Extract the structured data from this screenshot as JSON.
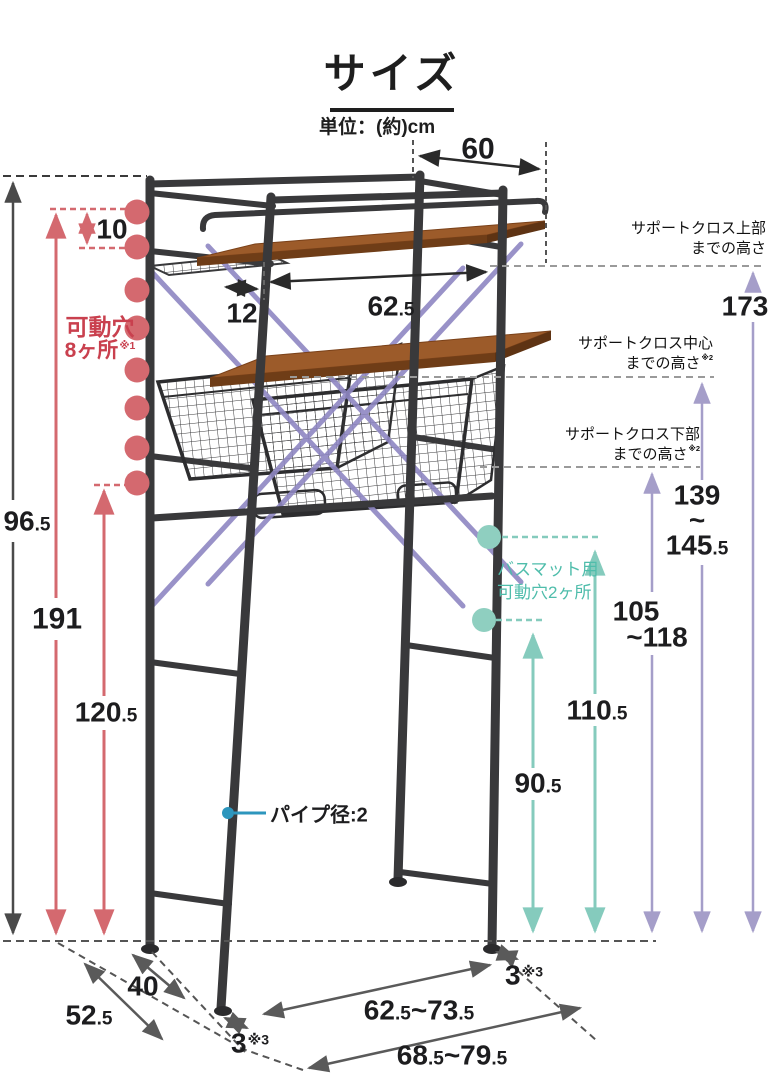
{
  "title": "サイズ",
  "unit": "単位：(約)cm",
  "dims": {
    "top_width": "60",
    "offset": "12",
    "shelf_width": "62.5",
    "gap": "10",
    "h_outer": "96.5",
    "h_total": "191",
    "h_lower": "120.5",
    "support_top": "173",
    "support_mid_a": "139",
    "support_mid_b": "~",
    "support_mid_c": "145.5",
    "support_low_a": "105",
    "support_low_b": "~118",
    "bath_upper": "110.5",
    "bath_lower": "90.5",
    "depth_inner": "40",
    "depth_outer": "52.5",
    "width_inner": "62.5~73.5",
    "width_outer": "68.5~79.5",
    "foot": "3",
    "foot_ref": "※3"
  },
  "labels": {
    "holes_a": "可動穴",
    "holes_b": "8ヶ所",
    "holes_ref": "※1",
    "support_top_a": "サポートクロス上部",
    "support_top_b": "までの高さ",
    "support_mid_a": "サポートクロス中心",
    "support_mid_b": "までの高さ",
    "support_mid_ref": "※2",
    "support_low_a": "サポートクロス下部",
    "support_low_b": "までの高さ",
    "support_low_ref": "※2",
    "bath_a": "バスマット用",
    "bath_b": "可動穴2ヶ所",
    "pipe": "パイプ径:2"
  },
  "colors": {
    "frame": "#39393b",
    "wood": "#9c5b2a",
    "accent_red": "#d4696f",
    "accent_red_text": "#c9404e",
    "accent_teal": "#85cbbd",
    "accent_teal_text": "#4fbdab",
    "accent_purple": "#a59ec9",
    "callout_blue": "#2d96bd"
  }
}
